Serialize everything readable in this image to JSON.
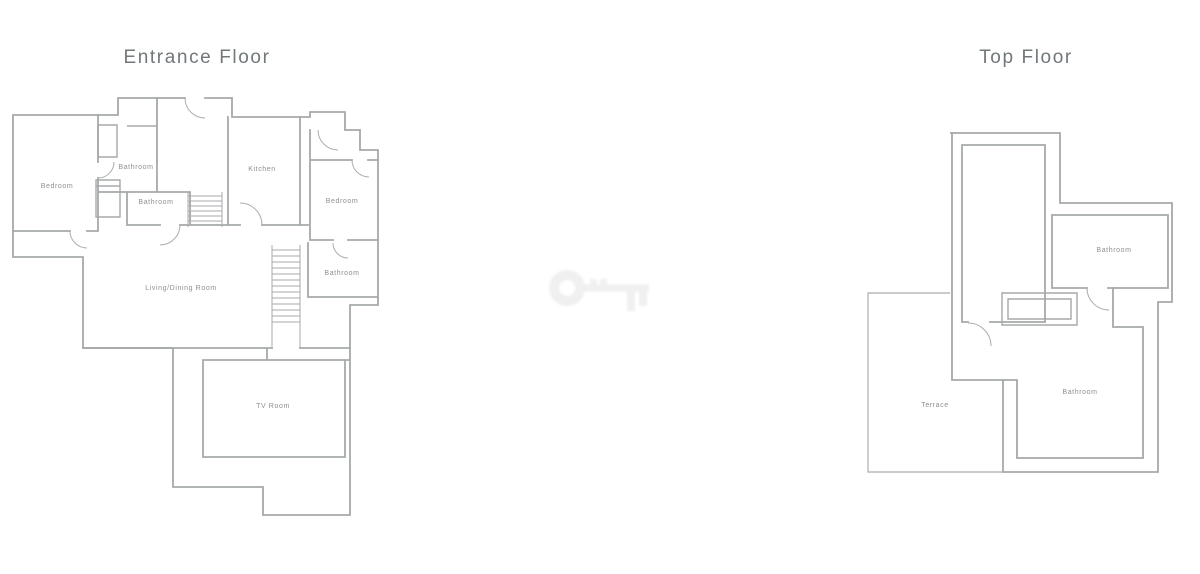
{
  "page": {
    "background": "#ffffff"
  },
  "colors": {
    "wall": "#a6a9ab",
    "terrace_line": "#b6b9bb",
    "room_label": "#8b8f92",
    "floor_title": "#71777a",
    "watermark": "#f0f0f0"
  },
  "entrance_floor": {
    "title": "Entrance Floor",
    "labels": {
      "bedroom_left": "Bedroom",
      "bathroom_top": "Bathroom",
      "bathroom_mid": "Bathroom",
      "kitchen": "Kitchen",
      "bedroom_right": "Bedroom",
      "bathroom_right": "Bathroom",
      "living_dining": "Living/Dining Room",
      "tv_room": "TV Room"
    }
  },
  "top_floor": {
    "title": "Top Floor",
    "labels": {
      "bathroom_upper": "Bathroom",
      "bathroom_lower": "Bathroom",
      "terrace": "Terrace"
    }
  },
  "watermark": {
    "icon": "key-icon"
  }
}
